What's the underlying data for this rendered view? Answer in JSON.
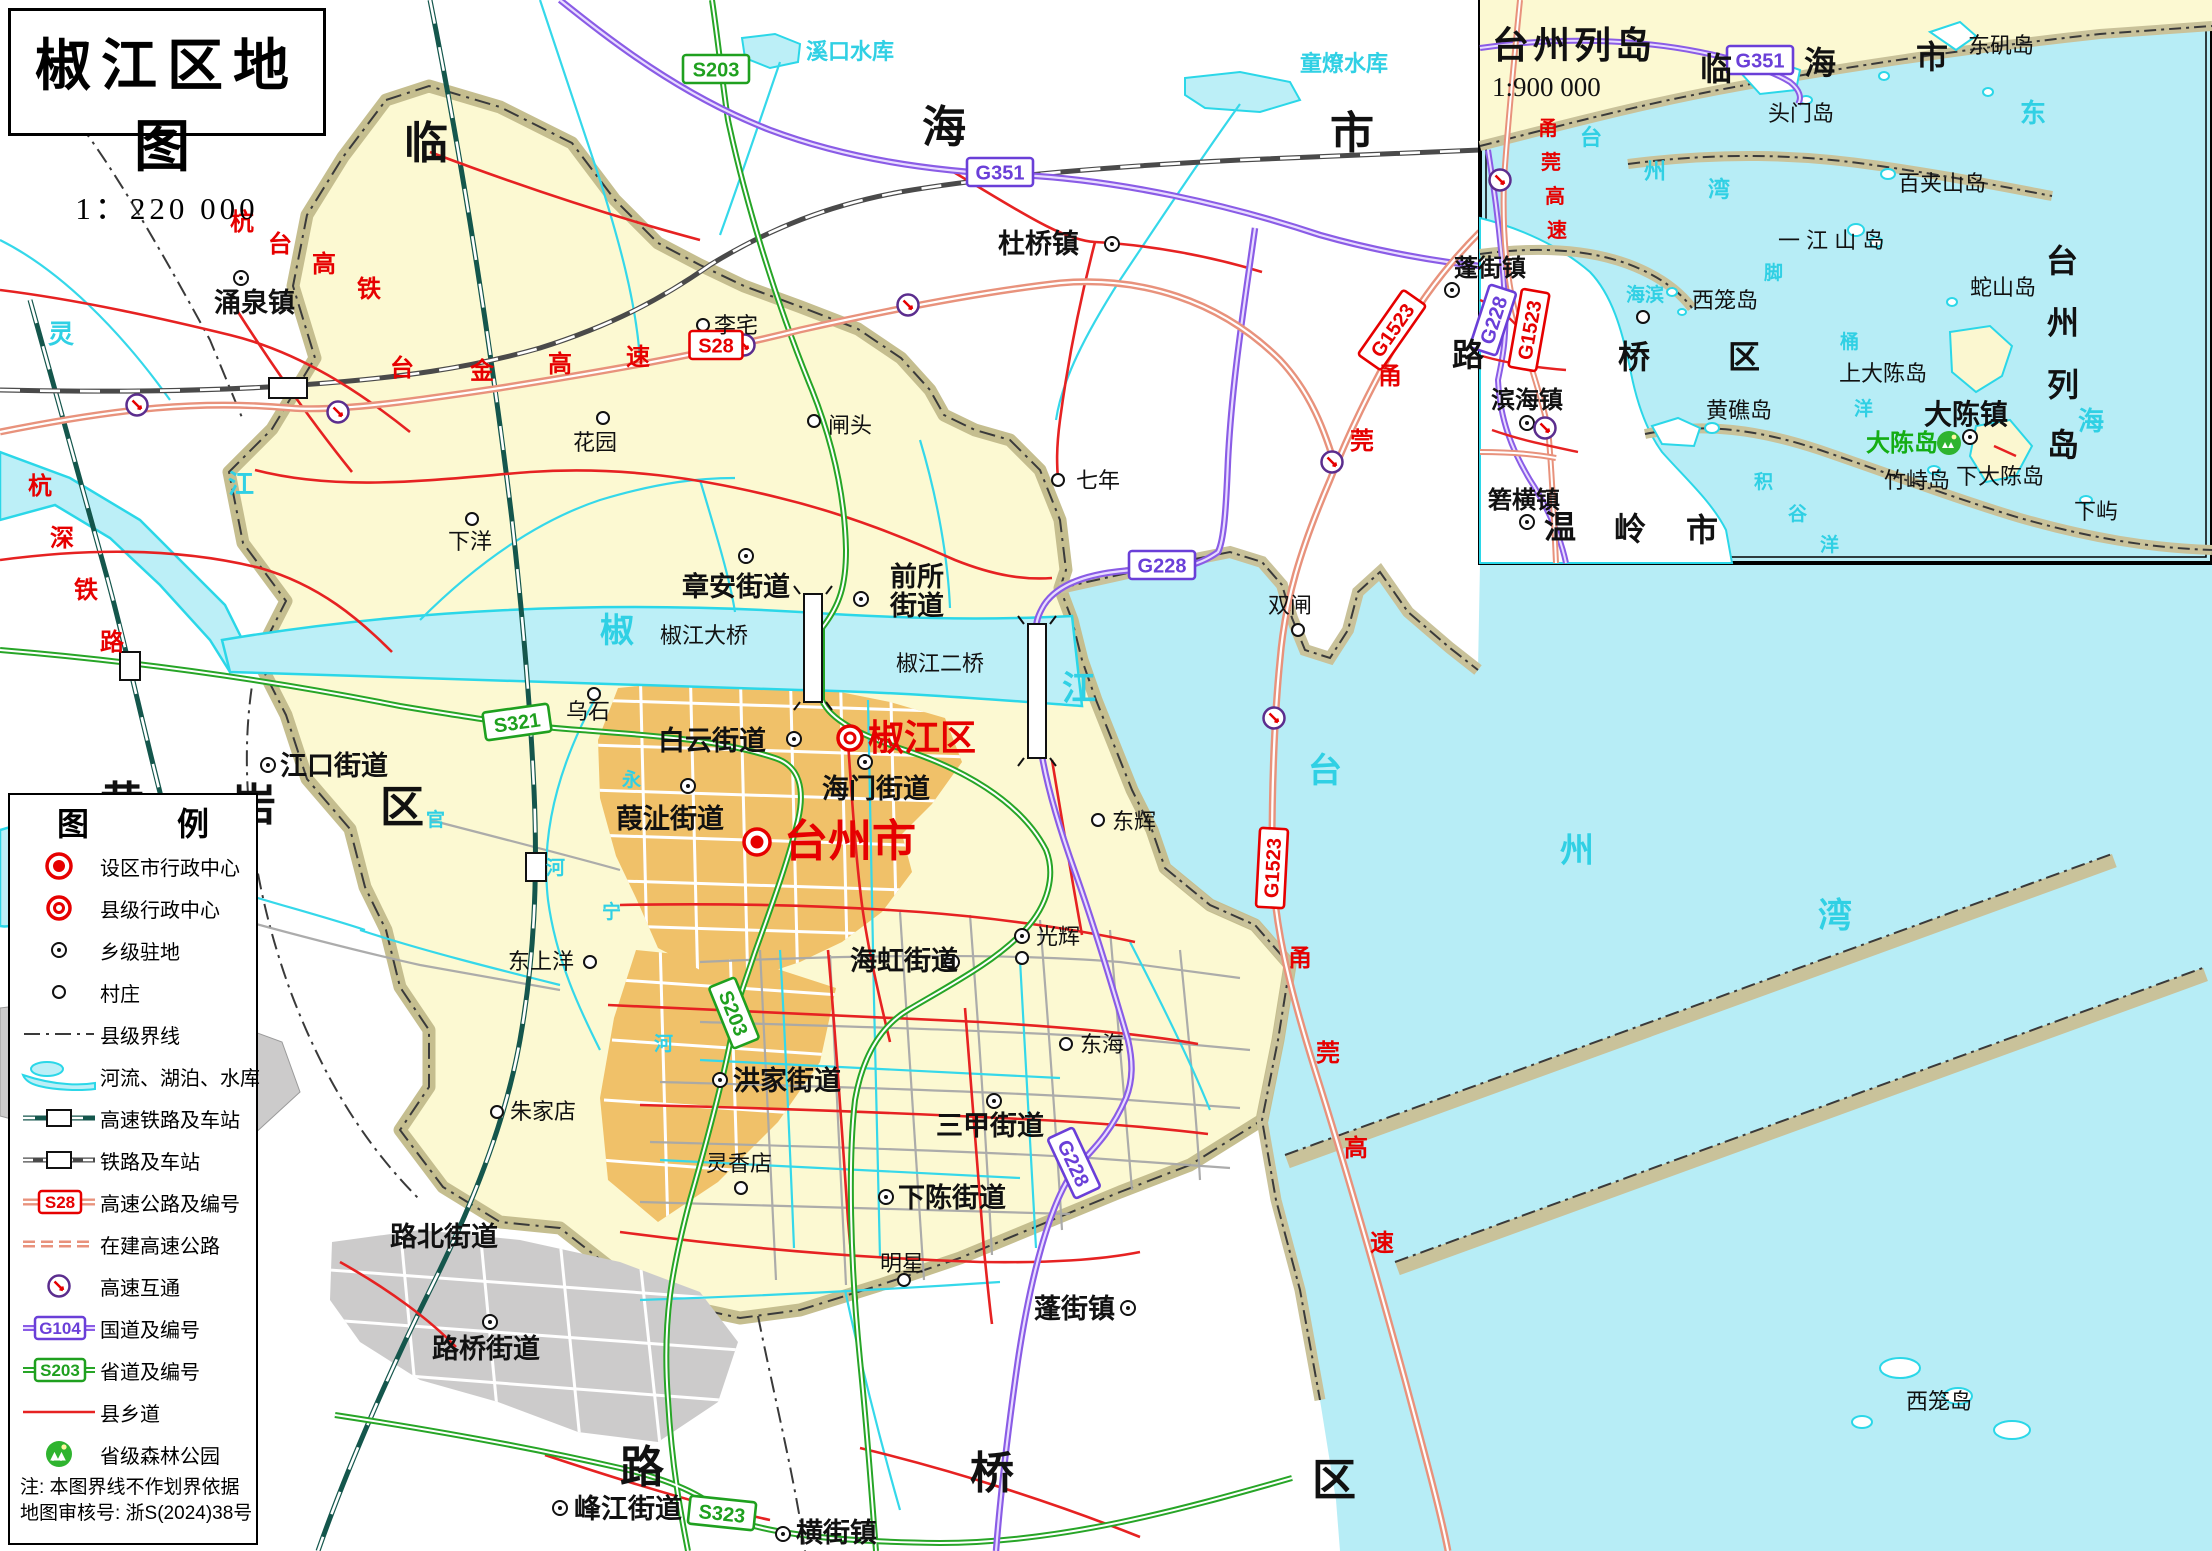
{
  "title": {
    "main": "椒江区地图",
    "scale": "1：220 000"
  },
  "inset": {
    "title": "台州列岛",
    "scale": "1:900 000"
  },
  "legend": {
    "title": "图 例",
    "items": [
      {
        "label": "设区市行政中心"
      },
      {
        "label": "县级行政中心"
      },
      {
        "label": "乡级驻地"
      },
      {
        "label": "村庄"
      },
      {
        "label": "县级界线"
      },
      {
        "label": "河流、湖泊、水库"
      },
      {
        "label": "高速铁路及车站"
      },
      {
        "label": "铁路及车站"
      },
      {
        "label": "高速公路及编号",
        "badge": "S28"
      },
      {
        "label": "在建高速公路"
      },
      {
        "label": "高速互通"
      },
      {
        "label": "国道及编号",
        "badge": "G104"
      },
      {
        "label": "省道及编号",
        "badge": "S203"
      },
      {
        "label": "县乡道"
      },
      {
        "label": "省级森林公园"
      }
    ],
    "notes": [
      "注: 本图界线不作划界依据",
      "地图审核号: 浙S(2024)38号"
    ]
  },
  "map": {
    "labels": [
      {
        "t": "临",
        "x": 404,
        "y": 158,
        "c": "B"
      },
      {
        "t": "海",
        "x": 922,
        "y": 142,
        "c": "B"
      },
      {
        "t": "市",
        "x": 1330,
        "y": 148,
        "c": "B"
      },
      {
        "t": "黄",
        "x": 100,
        "y": 818,
        "c": "B"
      },
      {
        "t": "岩",
        "x": 232,
        "y": 820,
        "c": "B"
      },
      {
        "t": "区",
        "x": 380,
        "y": 822,
        "c": "B"
      },
      {
        "t": "路",
        "x": 620,
        "y": 1482,
        "c": "B"
      },
      {
        "t": "桥",
        "x": 970,
        "y": 1488,
        "c": "B"
      },
      {
        "t": "区",
        "x": 1312,
        "y": 1495,
        "c": "B"
      },
      {
        "t": "台州市",
        "x": 784,
        "y": 856,
        "c": "RC"
      },
      {
        "t": "椒江区",
        "x": 868,
        "y": 750,
        "c": "RK"
      },
      {
        "t": "涌泉镇",
        "x": 214,
        "y": 312,
        "c": "t"
      },
      {
        "t": "杜桥镇",
        "x": 998,
        "y": 253,
        "c": "t"
      },
      {
        "t": "章安街道",
        "x": 682,
        "y": 596,
        "c": "t"
      },
      {
        "t": "前所",
        "x": 890,
        "y": 586,
        "c": "t"
      },
      {
        "t": "街道",
        "x": 890,
        "y": 615,
        "c": "t"
      },
      {
        "t": "白云街道",
        "x": 658,
        "y": 750,
        "c": "t"
      },
      {
        "t": "海门街道",
        "x": 822,
        "y": 798,
        "c": "t"
      },
      {
        "t": "葭沚街道",
        "x": 616,
        "y": 828,
        "c": "t"
      },
      {
        "t": "海虹街道",
        "x": 850,
        "y": 970,
        "c": "t"
      },
      {
        "t": "洪家街道",
        "x": 733,
        "y": 1090,
        "c": "t"
      },
      {
        "t": "三甲街道",
        "x": 936,
        "y": 1135,
        "c": "t"
      },
      {
        "t": "下陈街道",
        "x": 898,
        "y": 1207,
        "c": "t"
      },
      {
        "t": "蓬街镇",
        "x": 1034,
        "y": 1318,
        "c": "t"
      },
      {
        "t": "路北街道",
        "x": 390,
        "y": 1246,
        "c": "t"
      },
      {
        "t": "路桥街道",
        "x": 432,
        "y": 1358,
        "c": "t"
      },
      {
        "t": "峰江街道",
        "x": 574,
        "y": 1518,
        "c": "t"
      },
      {
        "t": "横街镇",
        "x": 796,
        "y": 1542,
        "c": "t"
      },
      {
        "t": "江口街道",
        "x": 280,
        "y": 775,
        "c": "t"
      },
      {
        "t": "李宅",
        "x": 714,
        "y": 333,
        "c": "v"
      },
      {
        "t": "花园",
        "x": 573,
        "y": 450,
        "c": "v"
      },
      {
        "t": "闸头",
        "x": 828,
        "y": 433,
        "c": "v"
      },
      {
        "t": "下洋",
        "x": 448,
        "y": 549,
        "c": "v"
      },
      {
        "t": "乌石",
        "x": 566,
        "y": 719,
        "c": "v"
      },
      {
        "t": "七年",
        "x": 1076,
        "y": 488,
        "c": "v"
      },
      {
        "t": "双闸",
        "x": 1268,
        "y": 613,
        "c": "v"
      },
      {
        "t": "东上洋",
        "x": 508,
        "y": 969,
        "c": "v"
      },
      {
        "t": "东辉",
        "x": 1112,
        "y": 829,
        "c": "v"
      },
      {
        "t": "光辉",
        "x": 1036,
        "y": 944,
        "c": "v"
      },
      {
        "t": "东海",
        "x": 1080,
        "y": 1052,
        "c": "v"
      },
      {
        "t": "灵香店",
        "x": 706,
        "y": 1171,
        "c": "v"
      },
      {
        "t": "明星",
        "x": 880,
        "y": 1271,
        "c": "v"
      },
      {
        "t": "朱家店",
        "x": 510,
        "y": 1119,
        "c": "v"
      },
      {
        "t": "西笼岛",
        "x": 1906,
        "y": 1409,
        "c": "v"
      },
      {
        "t": "椒江大桥",
        "x": 660,
        "y": 643,
        "c": "br"
      },
      {
        "t": "椒江二桥",
        "x": 896,
        "y": 671,
        "c": "br"
      },
      {
        "t": "溪口水库",
        "x": 806,
        "y": 59,
        "c": "wm"
      },
      {
        "t": "童燎水库",
        "x": 1300,
        "y": 71,
        "c": "wm"
      },
      {
        "t": "灵",
        "x": 48,
        "y": 343,
        "c": "W"
      },
      {
        "t": "江",
        "x": 228,
        "y": 493,
        "c": "W"
      },
      {
        "t": "椒",
        "x": 600,
        "y": 642,
        "c": "W2"
      },
      {
        "t": "江",
        "x": 1062,
        "y": 700,
        "c": "W2"
      },
      {
        "t": "台",
        "x": 1308,
        "y": 782,
        "c": "W2"
      },
      {
        "t": "州",
        "x": 1560,
        "y": 862,
        "c": "W2"
      },
      {
        "t": "湾",
        "x": 1818,
        "y": 927,
        "c": "W2"
      },
      {
        "t": "官",
        "x": 426,
        "y": 826,
        "c": "w"
      },
      {
        "t": "永",
        "x": 622,
        "y": 786,
        "c": "w"
      },
      {
        "t": "河",
        "x": 546,
        "y": 874,
        "c": "w"
      },
      {
        "t": "宁",
        "x": 602,
        "y": 918,
        "c": "w"
      },
      {
        "t": "河",
        "x": 654,
        "y": 1050,
        "c": "w"
      },
      {
        "t": "杭",
        "x": 230,
        "y": 230,
        "c": "R"
      },
      {
        "t": "台",
        "x": 268,
        "y": 252,
        "c": "R"
      },
      {
        "t": "高",
        "x": 312,
        "y": 272,
        "c": "R"
      },
      {
        "t": "铁",
        "x": 357,
        "y": 297,
        "c": "R"
      },
      {
        "t": "杭",
        "x": 28,
        "y": 494,
        "c": "R"
      },
      {
        "t": "深",
        "x": 50,
        "y": 546,
        "c": "R"
      },
      {
        "t": "铁",
        "x": 74,
        "y": 598,
        "c": "R"
      },
      {
        "t": "路",
        "x": 100,
        "y": 650,
        "c": "R"
      },
      {
        "t": "台",
        "x": 390,
        "y": 376,
        "c": "R"
      },
      {
        "t": "金",
        "x": 470,
        "y": 379,
        "c": "R"
      },
      {
        "t": "高",
        "x": 548,
        "y": 372,
        "c": "R"
      },
      {
        "t": "速",
        "x": 626,
        "y": 365,
        "c": "R"
      },
      {
        "t": "甬",
        "x": 1378,
        "y": 384,
        "c": "R"
      },
      {
        "t": "莞",
        "x": 1350,
        "y": 449,
        "c": "R"
      },
      {
        "t": "甬",
        "x": 1288,
        "y": 966,
        "c": "R"
      },
      {
        "t": "莞",
        "x": 1316,
        "y": 1061,
        "c": "R"
      },
      {
        "t": "高",
        "x": 1344,
        "y": 1156,
        "c": "R"
      },
      {
        "t": "速",
        "x": 1370,
        "y": 1251,
        "c": "R"
      },
      {
        "t": "临",
        "x": 1700,
        "y": 80,
        "c": "IB"
      },
      {
        "t": "海",
        "x": 1804,
        "y": 74,
        "c": "IB"
      },
      {
        "t": "市",
        "x": 1916,
        "y": 68,
        "c": "IB"
      },
      {
        "t": "路",
        "x": 1452,
        "y": 366,
        "c": "IB"
      },
      {
        "t": "桥",
        "x": 1618,
        "y": 368,
        "c": "IB"
      },
      {
        "t": "区",
        "x": 1728,
        "y": 368,
        "c": "IB"
      },
      {
        "t": "温",
        "x": 1544,
        "y": 538,
        "c": "IB"
      },
      {
        "t": "岭",
        "x": 1614,
        "y": 540,
        "c": "IB"
      },
      {
        "t": "市",
        "x": 1686,
        "y": 541,
        "c": "IB"
      },
      {
        "t": "台",
        "x": 2046,
        "y": 272,
        "c": "IB"
      },
      {
        "t": "州",
        "x": 2047,
        "y": 334,
        "c": "IB"
      },
      {
        "t": "列",
        "x": 2047,
        "y": 396,
        "c": "IB"
      },
      {
        "t": "岛",
        "x": 2047,
        "y": 456,
        "c": "IB"
      },
      {
        "t": "东矶岛",
        "x": 1968,
        "y": 53,
        "c": "I"
      },
      {
        "t": "头门岛",
        "x": 1768,
        "y": 121,
        "c": "I"
      },
      {
        "t": "百夹山岛",
        "x": 1898,
        "y": 191,
        "c": "I"
      },
      {
        "t": "一 江 山 岛",
        "x": 1778,
        "y": 248,
        "c": "I"
      },
      {
        "t": "蛇山岛",
        "x": 1970,
        "y": 295,
        "c": "I"
      },
      {
        "t": "西笼岛",
        "x": 1692,
        "y": 308,
        "c": "I"
      },
      {
        "t": "黄礁岛",
        "x": 1706,
        "y": 418,
        "c": "I"
      },
      {
        "t": "上大陈岛",
        "x": 1839,
        "y": 381,
        "c": "I"
      },
      {
        "t": "下大陈岛",
        "x": 1956,
        "y": 484,
        "c": "I"
      },
      {
        "t": "竹峙岛",
        "x": 1884,
        "y": 488,
        "c": "I"
      },
      {
        "t": "下屿",
        "x": 2074,
        "y": 519,
        "c": "I"
      },
      {
        "t": "大陈镇",
        "x": 1924,
        "y": 424,
        "c": "ITB"
      },
      {
        "t": "蓬街镇",
        "x": 1454,
        "y": 276,
        "c": "IT"
      },
      {
        "t": "滨海镇",
        "x": 1491,
        "y": 408,
        "c": "IT"
      },
      {
        "t": "箬横镇",
        "x": 1488,
        "y": 508,
        "c": "IT"
      },
      {
        "t": "大陈岛",
        "x": 1866,
        "y": 451,
        "c": "G"
      },
      {
        "t": "东",
        "x": 2020,
        "y": 122,
        "c": "W"
      },
      {
        "t": "海",
        "x": 2078,
        "y": 430,
        "c": "W"
      },
      {
        "t": "台",
        "x": 1580,
        "y": 145,
        "c": "wm"
      },
      {
        "t": "州",
        "x": 1644,
        "y": 179,
        "c": "wm"
      },
      {
        "t": "湾",
        "x": 1708,
        "y": 197,
        "c": "wm"
      },
      {
        "t": "脚",
        "x": 1764,
        "y": 279,
        "c": "w"
      },
      {
        "t": "桶",
        "x": 1840,
        "y": 348,
        "c": "w"
      },
      {
        "t": "洋",
        "x": 1854,
        "y": 415,
        "c": "w"
      },
      {
        "t": "积",
        "x": 1754,
        "y": 488,
        "c": "w"
      },
      {
        "t": "谷",
        "x": 1788,
        "y": 520,
        "c": "w"
      },
      {
        "t": "洋",
        "x": 1820,
        "y": 551,
        "c": "w"
      },
      {
        "t": "海滨",
        "x": 1626,
        "y": 301,
        "c": "w"
      },
      {
        "t": "甬",
        "x": 1538,
        "y": 135,
        "c": "Ri"
      },
      {
        "t": "莞",
        "x": 1541,
        "y": 169,
        "c": "Ri"
      },
      {
        "t": "高",
        "x": 1545,
        "y": 203,
        "c": "Ri"
      },
      {
        "t": "速",
        "x": 1547,
        "y": 237,
        "c": "Ri"
      },
      {
        "t": "台州列岛",
        "x": 1492,
        "y": 58,
        "c": "ti",
        "n": "inset-title"
      },
      {
        "t": "1:900 000",
        "x": 1492,
        "y": 96,
        "c": "ts",
        "n": "inset-scale"
      }
    ],
    "badges": [
      {
        "t": "S28",
        "x": 716,
        "y": 345,
        "k": "exp"
      },
      {
        "t": "S321",
        "x": 517,
        "y": 722,
        "k": "prov",
        "r": -8
      },
      {
        "t": "S203",
        "x": 716,
        "y": 69,
        "k": "prov"
      },
      {
        "t": "S203",
        "x": 734,
        "y": 1013,
        "k": "prov",
        "r": 68
      },
      {
        "t": "S323",
        "x": 722,
        "y": 1513,
        "k": "prov",
        "r": 6
      },
      {
        "t": "G351",
        "x": 1000,
        "y": 172,
        "k": "nat"
      },
      {
        "t": "G228",
        "x": 1162,
        "y": 565,
        "k": "nat"
      },
      {
        "t": "G228",
        "x": 1074,
        "y": 1163,
        "k": "nat",
        "r": 65
      },
      {
        "t": "G1523",
        "x": 1392,
        "y": 330,
        "k": "exp",
        "r": -55
      },
      {
        "t": "G1523",
        "x": 1272,
        "y": 868,
        "k": "exp",
        "r": -87
      },
      {
        "t": "G351",
        "x": 1760,
        "y": 60,
        "k": "nat"
      },
      {
        "t": "G228",
        "x": 1493,
        "y": 320,
        "k": "nat",
        "r": -72
      },
      {
        "t": "G1523",
        "x": 1529,
        "y": 330,
        "k": "exp",
        "r": -80
      }
    ],
    "markers": [
      {
        "k": "city",
        "x": 757,
        "y": 842
      },
      {
        "k": "county",
        "x": 850,
        "y": 738
      },
      {
        "k": "town",
        "x": 241,
        "y": 278
      },
      {
        "k": "town",
        "x": 1112,
        "y": 244
      },
      {
        "k": "town",
        "x": 746,
        "y": 556
      },
      {
        "k": "town",
        "x": 861,
        "y": 599
      },
      {
        "k": "town",
        "x": 794,
        "y": 739
      },
      {
        "k": "town",
        "x": 865,
        "y": 762
      },
      {
        "k": "town",
        "x": 688,
        "y": 786
      },
      {
        "k": "town",
        "x": 268,
        "y": 765
      },
      {
        "k": "town",
        "x": 720,
        "y": 1080
      },
      {
        "k": "town",
        "x": 994,
        "y": 1101
      },
      {
        "k": "town",
        "x": 886,
        "y": 1197
      },
      {
        "k": "town",
        "x": 952,
        "y": 962
      },
      {
        "k": "town",
        "x": 1128,
        "y": 1308
      },
      {
        "k": "town",
        "x": 560,
        "y": 1508
      },
      {
        "k": "town",
        "x": 783,
        "y": 1534
      },
      {
        "k": "town",
        "x": 490,
        "y": 1322
      },
      {
        "k": "town",
        "x": 1022,
        "y": 936
      },
      {
        "k": "vill",
        "x": 703,
        "y": 325
      },
      {
        "k": "vill",
        "x": 603,
        "y": 418
      },
      {
        "k": "vill",
        "x": 814,
        "y": 421
      },
      {
        "k": "vill",
        "x": 472,
        "y": 519
      },
      {
        "k": "vill",
        "x": 594,
        "y": 694
      },
      {
        "k": "vill",
        "x": 1058,
        "y": 480
      },
      {
        "k": "vill",
        "x": 1298,
        "y": 630
      },
      {
        "k": "vill",
        "x": 590,
        "y": 962
      },
      {
        "k": "vill",
        "x": 1098,
        "y": 820
      },
      {
        "k": "vill",
        "x": 1022,
        "y": 958
      },
      {
        "k": "vill",
        "x": 1066,
        "y": 1044
      },
      {
        "k": "vill",
        "x": 741,
        "y": 1188
      },
      {
        "k": "vill",
        "x": 904,
        "y": 1280
      },
      {
        "k": "vill",
        "x": 497,
        "y": 1112
      },
      {
        "k": "town",
        "x": 1452,
        "y": 290
      },
      {
        "k": "town",
        "x": 1527,
        "y": 423
      },
      {
        "k": "town",
        "x": 1527,
        "y": 522
      },
      {
        "k": "town",
        "x": 1970,
        "y": 437
      },
      {
        "k": "vill",
        "x": 1643,
        "y": 317
      }
    ],
    "interchanges": [
      [
        137,
        405
      ],
      [
        338,
        412
      ],
      [
        744,
        345
      ],
      [
        908,
        305
      ],
      [
        1332,
        462
      ],
      [
        1274,
        718
      ],
      [
        1500,
        180
      ],
      [
        1545,
        428
      ]
    ],
    "stations": [
      [
        526,
        853,
        20,
        28
      ],
      [
        120,
        652,
        20,
        28
      ],
      [
        269,
        378,
        38,
        20
      ]
    ],
    "forest": [
      [
        1949,
        443
      ]
    ]
  }
}
